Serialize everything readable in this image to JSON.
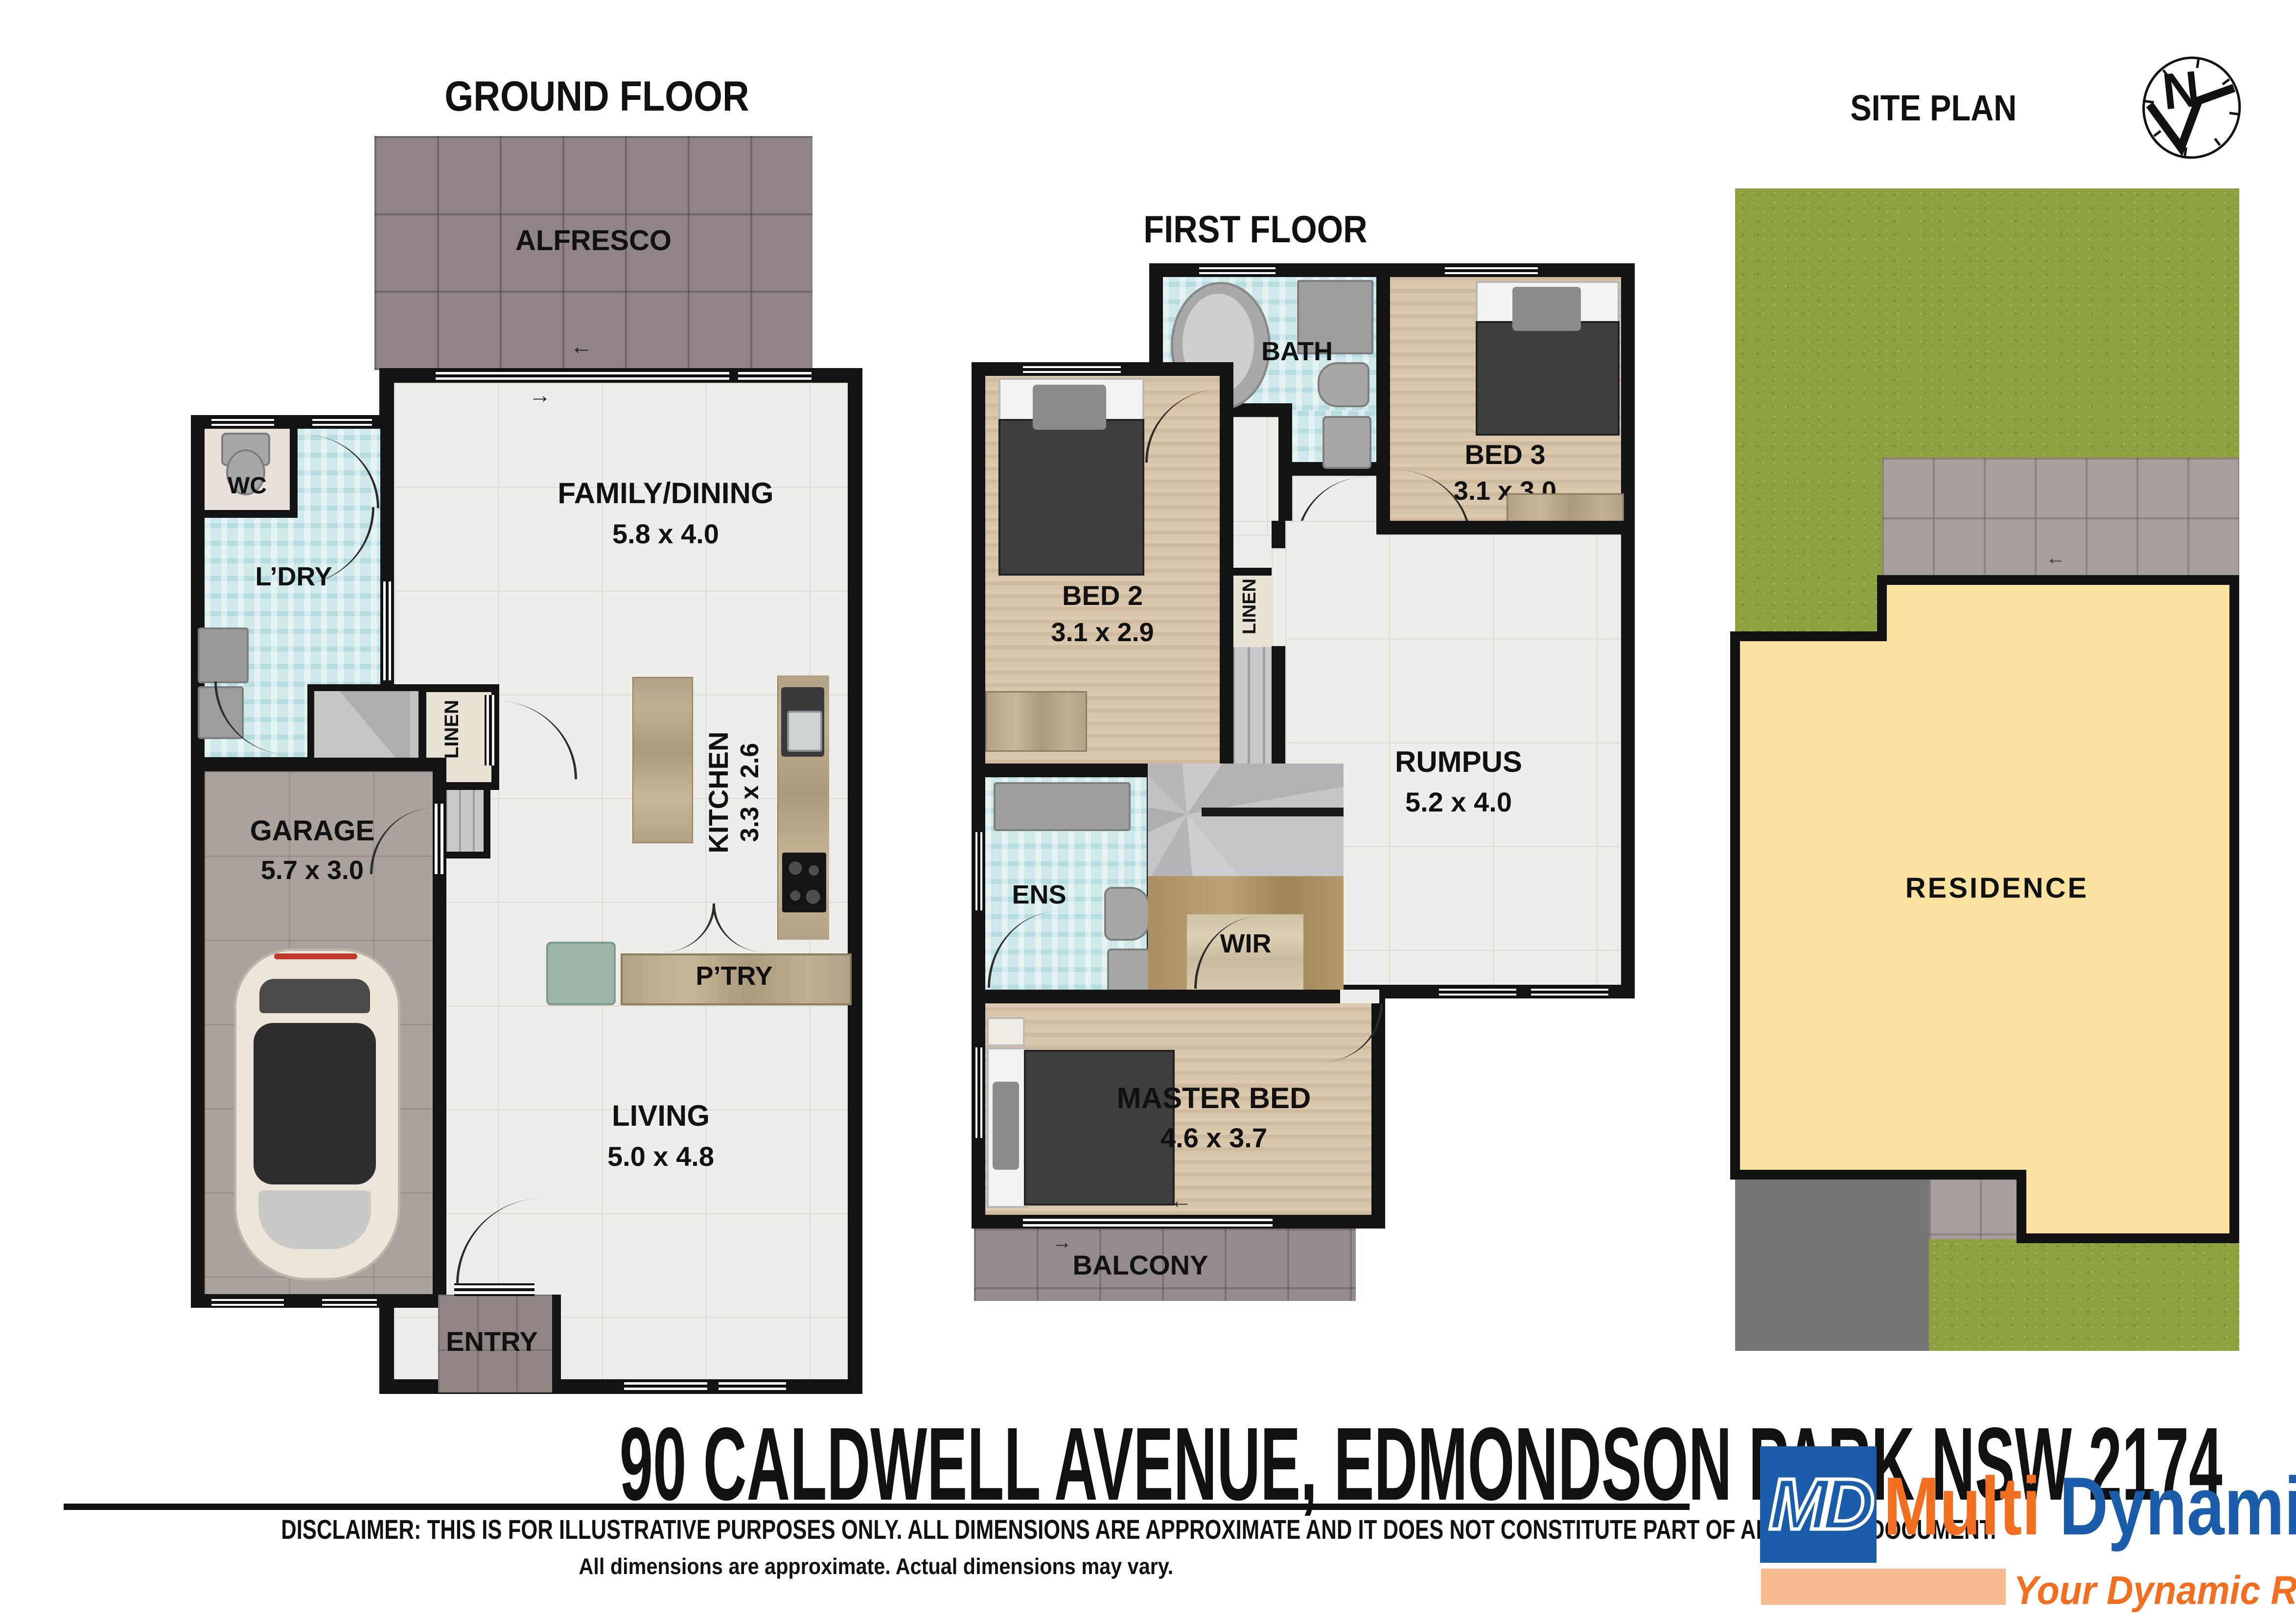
{
  "ground": {
    "title": "GROUND FLOOR",
    "rooms": {
      "alfresco": {
        "label": "ALFRESCO"
      },
      "wc": {
        "label": "WC"
      },
      "ldry": {
        "label": "L’DRY"
      },
      "family": {
        "label": "FAMILY/DINING",
        "dims": "5.8 x 4.0"
      },
      "linen": {
        "label": "LINEN"
      },
      "kitchen": {
        "label": "KITCHEN",
        "dims": "3.3 x 2.6"
      },
      "garage": {
        "label": "GARAGE",
        "dims": "5.7 x 3.0"
      },
      "pantry": {
        "label": "P’TRY"
      },
      "living": {
        "label": "LIVING",
        "dims": "5.0 x 4.8"
      },
      "entry": {
        "label": "ENTRY"
      }
    }
  },
  "first": {
    "title": "FIRST FLOOR",
    "rooms": {
      "bath": {
        "label": "BATH"
      },
      "bed3": {
        "label": "BED 3",
        "dims": "3.1 x 3.0"
      },
      "bed2": {
        "label": "BED 2",
        "dims": "3.1 x 2.9"
      },
      "linen": {
        "label": "LINEN"
      },
      "rumpus": {
        "label": "RUMPUS",
        "dims": "5.2 x 4.0"
      },
      "ens": {
        "label": "ENS"
      },
      "wir": {
        "label": "WIR"
      },
      "master": {
        "label": "MASTER BED",
        "dims": "4.6 x 3.7"
      },
      "balcony": {
        "label": "BALCONY"
      }
    }
  },
  "site": {
    "title": "SITE PLAN",
    "residence": "RESIDENCE"
  },
  "icons": {
    "compass_letter": "N",
    "arrow_left": "←",
    "arrow_right": "→"
  },
  "footer": {
    "address": "90 CALDWELL AVENUE, EDMONDSON PARK NSW 2174",
    "disclaimer_line1": "DISCLAIMER: THIS IS FOR ILLUSTRATIVE PURPOSES ONLY. ALL DIMENSIONS ARE APPROXIMATE AND IT DOES NOT CONSTITUTE PART OF ANY LEGAL DOCUMENT.",
    "disclaimer_line2": "All dimensions are approximate. Actual dimensions may vary.",
    "logo": {
      "monogram": "MD",
      "brand_part1": "Multi",
      "brand_part2": "Dynamic",
      "tagline": "Your Dynamic Real Estate"
    },
    "colors": {
      "brand_blue": "#1b5dab",
      "brand_orange": "#f26f21",
      "brand_peach": "#f7bb8f"
    }
  }
}
